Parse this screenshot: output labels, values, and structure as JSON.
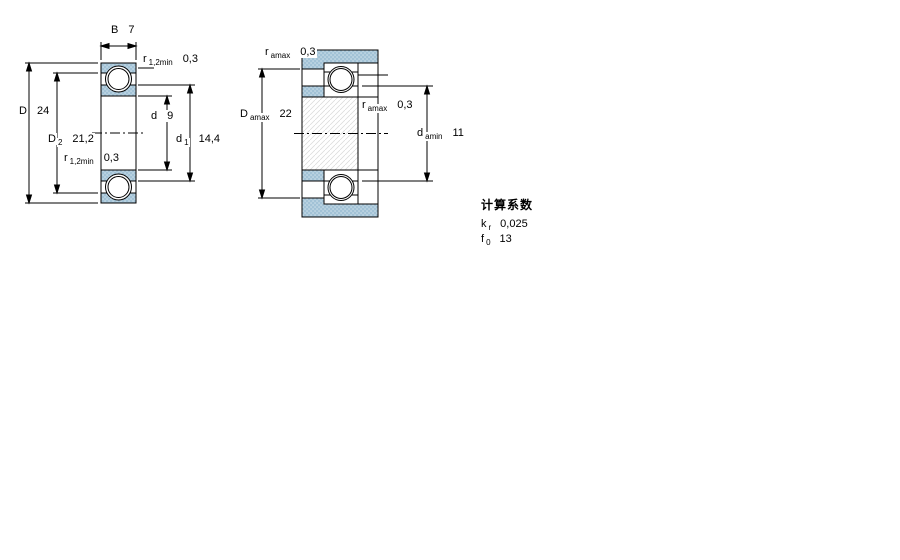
{
  "drawing": {
    "title": "bearing-dimension-drawing",
    "colors": {
      "ring_fill": "#a2c2d6",
      "ring_dot_light": "#d3e3ed",
      "line": "#000000",
      "shaft_hatch": "#d9d9d9",
      "background": "#ffffff"
    },
    "view1": {
      "name": "bearing-cross-section",
      "dims": {
        "B": {
          "symbol": "B",
          "sub": "",
          "value": "7"
        },
        "r_top": {
          "symbol": "r",
          "sub": "1,2min",
          "value": "0,3"
        },
        "D": {
          "symbol": "D",
          "sub": "",
          "value": "24"
        },
        "D2": {
          "symbol": "D",
          "sub": "2",
          "value": "21,2"
        },
        "r_bottom": {
          "symbol": "r",
          "sub": "1,2min",
          "value": "0,3"
        },
        "d": {
          "symbol": "d",
          "sub": "",
          "value": "9"
        },
        "d1": {
          "symbol": "d",
          "sub": "1",
          "value": "14,4"
        }
      }
    },
    "view2": {
      "name": "mounted-bearing-abutment-section",
      "dims": {
        "ra_top": {
          "symbol": "r",
          "sub": "amax",
          "value": "0,3"
        },
        "Da": {
          "symbol": "D",
          "sub": "amax",
          "value": "22"
        },
        "ra_mid": {
          "symbol": "r",
          "sub": "amax",
          "value": "0,3"
        },
        "da": {
          "symbol": "d",
          "sub": "amin",
          "value": "11"
        }
      }
    },
    "calc": {
      "heading": "计算系数",
      "factors": [
        {
          "symbol": "k",
          "sub": "r",
          "value": "0,025"
        },
        {
          "symbol": "f",
          "sub": "0",
          "value": "13"
        }
      ]
    }
  }
}
